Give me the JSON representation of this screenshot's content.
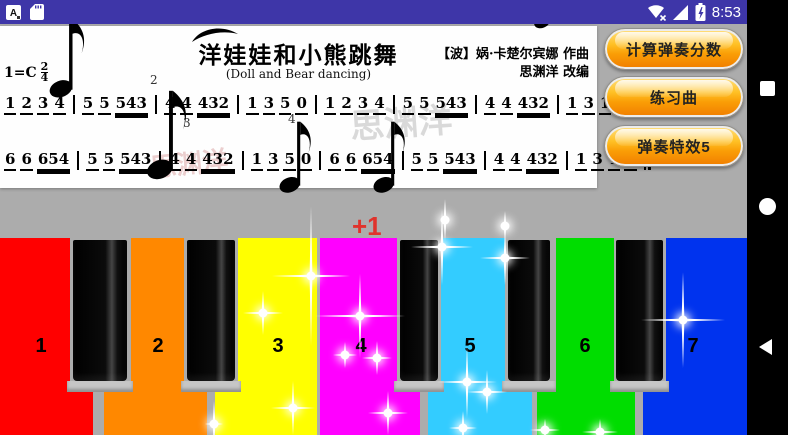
{
  "status_bar": {
    "time": "8:53",
    "bg_color": "#3E36A8"
  },
  "sheet": {
    "key_signature": {
      "key": "1=C",
      "meter_numerator": "2",
      "meter_denominator": "4"
    },
    "title": "洋娃娃和小熊跳舞",
    "subtitle": "(Doll and Bear dancing)",
    "composer": "【波】娲·卡楚尔宾娜 作曲",
    "arranger": "思渊洋 改编",
    "watermark": "思渊洋",
    "annotations": [
      {
        "text": "2",
        "x": 150,
        "y": 47
      },
      {
        "text": "4",
        "x": 288,
        "y": 86
      },
      {
        "text": "3",
        "x": 183,
        "y": 90
      }
    ],
    "lines": [
      {
        "measures": [
          [
            "1",
            "2",
            "3",
            "4"
          ],
          [
            "5",
            "5",
            "543"
          ],
          [
            "4",
            "4",
            "432"
          ],
          [
            "1",
            "3",
            "5",
            "0"
          ],
          [
            "1",
            "2",
            "3",
            "4"
          ],
          [
            "5",
            "5",
            "543"
          ],
          [
            "4",
            "4",
            "432"
          ],
          [
            "1",
            "3",
            "1",
            "0"
          ]
        ],
        "end": "single"
      },
      {
        "measures": [
          [
            "6",
            "6",
            "654"
          ],
          [
            "5",
            "5",
            "543"
          ],
          [
            "4",
            "4",
            "432"
          ],
          [
            "1",
            "3",
            "5",
            "0"
          ],
          [
            "6",
            "6",
            "654"
          ],
          [
            "5",
            "5",
            "543"
          ],
          [
            "4",
            "4",
            "432"
          ],
          [
            "1",
            "3",
            "1",
            "0"
          ]
        ],
        "end": "double"
      }
    ]
  },
  "score_panel": {
    "buttons": [
      {
        "label": "计算弹奏分数"
      },
      {
        "label": "练习曲"
      },
      {
        "label": "弹奏特效5"
      }
    ]
  },
  "overlay": {
    "bonus_text": "+1",
    "bonus_color": "#E0332C"
  },
  "keyboard": {
    "keys": [
      {
        "number": "1",
        "color": "#FF0000",
        "upper": {
          "x": 0,
          "w": 70
        },
        "lower": {
          "x": 0,
          "w": 93
        },
        "label_x": 30
      },
      {
        "number": "2",
        "color": "#FF8800",
        "upper": {
          "x": 131,
          "w": 53
        },
        "lower": {
          "x": 104,
          "w": 103
        },
        "label_x": 147
      },
      {
        "number": "3",
        "color": "#FFFF00",
        "upper": {
          "x": 238,
          "w": 79
        },
        "lower": {
          "x": 215,
          "w": 102
        },
        "label_x": 267
      },
      {
        "number": "4",
        "color": "#FF00FF",
        "upper": {
          "x": 320,
          "w": 77
        },
        "lower": {
          "x": 320,
          "w": 100
        },
        "label_x": 350
      },
      {
        "number": "5",
        "color": "#33CCFF",
        "upper": {
          "x": 441,
          "w": 64
        },
        "lower": {
          "x": 428,
          "w": 104
        },
        "label_x": 459
      },
      {
        "number": "6",
        "color": "#00DD00",
        "upper": {
          "x": 556,
          "w": 58
        },
        "lower": {
          "x": 537,
          "w": 98
        },
        "label_x": 574
      },
      {
        "number": "7",
        "color": "#0033EE",
        "upper": {
          "x": 666,
          "w": 81
        },
        "lower": {
          "x": 643,
          "w": 104
        },
        "label_x": 682
      }
    ],
    "black_keys": [
      {
        "x": 73,
        "w": 54
      },
      {
        "x": 187,
        "w": 48
      },
      {
        "x": 400,
        "w": 38
      },
      {
        "x": 508,
        "w": 42
      },
      {
        "x": 616,
        "w": 47
      }
    ]
  },
  "sparkles": [
    {
      "x": 263,
      "y": 313,
      "v": 44,
      "h": 40
    },
    {
      "x": 311,
      "y": 276,
      "v": 140,
      "h": 78
    },
    {
      "x": 360,
      "y": 316,
      "v": 84,
      "h": 90
    },
    {
      "x": 345,
      "y": 355,
      "v": 26,
      "h": 24
    },
    {
      "x": 377,
      "y": 358,
      "v": 34,
      "h": 30
    },
    {
      "x": 293,
      "y": 408,
      "v": 54,
      "h": 44
    },
    {
      "x": 388,
      "y": 413,
      "v": 44,
      "h": 40
    },
    {
      "x": 214,
      "y": 424,
      "v": 46,
      "h": 18
    },
    {
      "x": 442,
      "y": 247,
      "v": 76,
      "h": 62
    },
    {
      "x": 505,
      "y": 258,
      "v": 54,
      "h": 50
    },
    {
      "x": 683,
      "y": 320,
      "v": 96,
      "h": 84
    },
    {
      "x": 467,
      "y": 382,
      "v": 72,
      "h": 60
    },
    {
      "x": 487,
      "y": 392,
      "v": 44,
      "h": 40
    },
    {
      "x": 463,
      "y": 428,
      "v": 34,
      "h": 28
    },
    {
      "x": 600,
      "y": 432,
      "v": 26,
      "h": 36
    },
    {
      "x": 445,
      "y": 220,
      "v": 42,
      "h": 10
    },
    {
      "x": 505,
      "y": 226,
      "v": 30,
      "h": 8
    },
    {
      "x": 545,
      "y": 430,
      "v": 22,
      "h": 30
    }
  ],
  "deco_notes": [
    {
      "x": 48,
      "y": 14,
      "h": 86
    },
    {
      "x": 145,
      "y": 85,
      "h": 97
    },
    {
      "x": 278,
      "y": 117,
      "h": 78
    },
    {
      "x": 372,
      "y": 117,
      "h": 78
    },
    {
      "x": 533,
      "y": -30,
      "h": 60
    }
  ],
  "deco_swoosh": {
    "x": 192,
    "y": 26
  }
}
